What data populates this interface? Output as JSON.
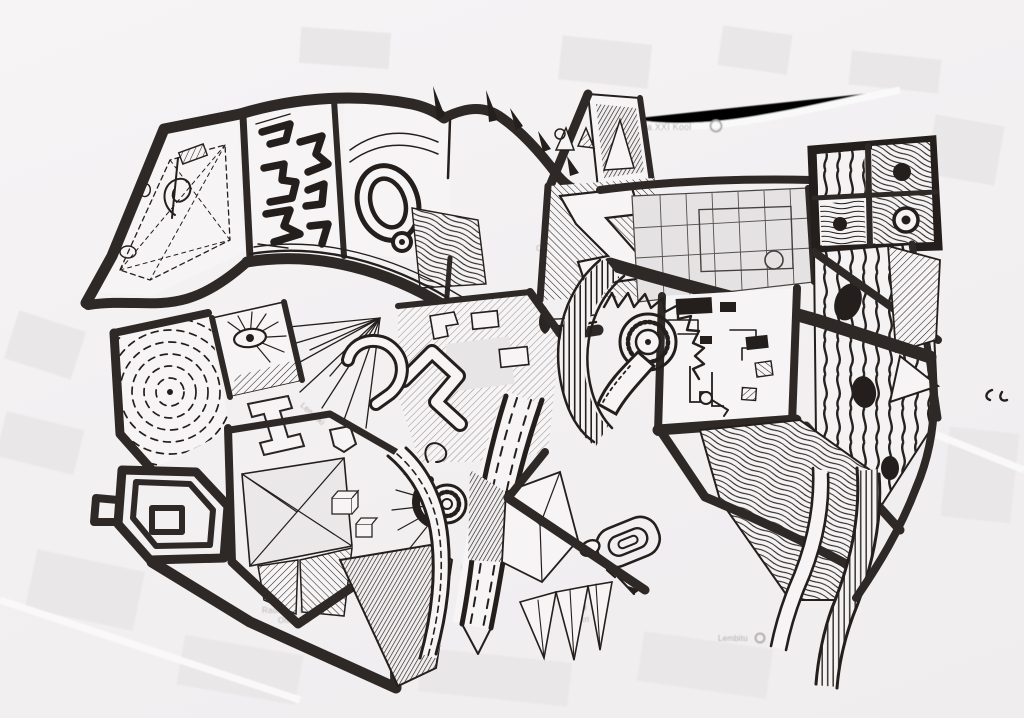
{
  "artwork": {
    "description": "Black-ink doodle drawing covering the city blocks of a faint printed street map",
    "paper_color": "#f3f1f2",
    "ink_color": "#241f1d",
    "street_marker_color": "#2e2926",
    "map_tint_color": "#e7e5e6",
    "map_label_color": "#b3aeb0",
    "building_plan_fill_color": "#e4e2e3"
  },
  "map_labels": {
    "school": "Tallinna XXI Kool",
    "radio": "radio",
    "club": "Club",
    "eesti": "Eesti",
    "swissotel": "Swissotel",
    "radisson_line1": "Radisson Blu Hotel",
    "radisson_line2": "Olümpia",
    "maakri": "Maakri",
    "lembitu": "Lembitu",
    "street_lennuki": "Lennuki"
  }
}
